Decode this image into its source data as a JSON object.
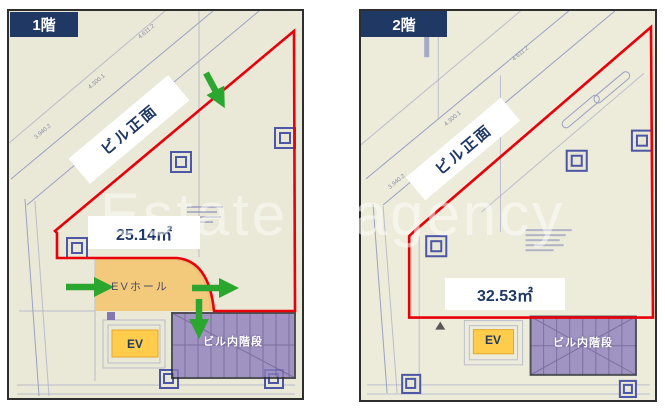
{
  "watermark": {
    "text": "Estate agency"
  },
  "colors": {
    "navy": "#1F3864",
    "red": "#E8000B",
    "green": "#2BA62F",
    "purple_fill": "#8E7FBE",
    "purple_border": "#2A2C38",
    "ev_yellow": "#FFCD4B",
    "hall_yellow": "#F4C36C",
    "paper": "#EAE8D6",
    "paper2": "#EDEBDA",
    "plan_line": "#9BA1C4"
  },
  "panels": {
    "floor1": {
      "tag": "1階",
      "front_label": "ビル正面",
      "area_label": "25.14㎡",
      "ev_hall_label": "EVホール",
      "ev_label": "EV",
      "stairs_label": "ビル内階段",
      "dims": [
        "4.611.2",
        "4.300.1",
        "3.940.2"
      ]
    },
    "floor2": {
      "tag": "2階",
      "front_label": "ビル正面",
      "area_label": "32.53㎡",
      "ev_label": "EV",
      "stairs_label": "ビル内階段",
      "dims": [
        "4.611.2",
        "4.300.1",
        "3.940.2"
      ]
    }
  }
}
